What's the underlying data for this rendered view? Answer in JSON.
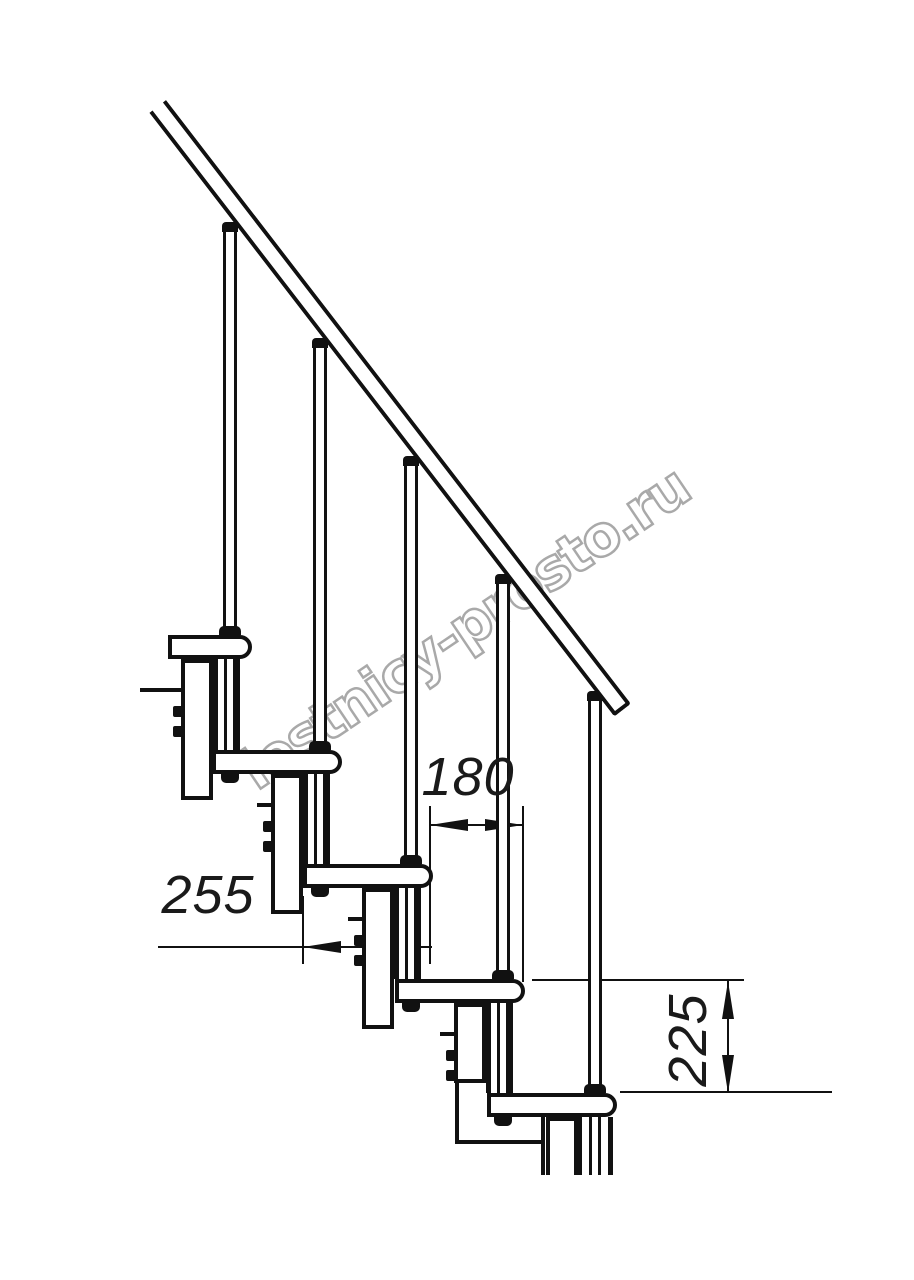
{
  "watermark": {
    "text": "lestnicy-prosto.ru",
    "stroke_color": "#a9a9a9"
  },
  "dimensions": {
    "step_run": {
      "label": "180"
    },
    "tread_depth": {
      "label": "255"
    },
    "step_rise": {
      "label": "225"
    }
  },
  "drawing": {
    "line_color": "#111111",
    "background": "#ffffff",
    "primitives": [
      [
        "tl",
        429,
        806,
        2,
        158,
        "extension-line"
      ],
      [
        "tl",
        522,
        806,
        2,
        176,
        "extension-line"
      ],
      [
        "tl",
        302,
        896,
        2,
        68,
        "extension-line"
      ],
      [
        "tl",
        158,
        946,
        274,
        2,
        "dimension-line-255"
      ],
      [
        "tl",
        430,
        824,
        94,
        2,
        "dimension-line-180"
      ],
      [
        "tl",
        532,
        979,
        212,
        2,
        "extension-line"
      ],
      [
        "tl",
        620,
        1091,
        212,
        2,
        "extension-line"
      ],
      [
        "tl",
        727,
        981,
        2,
        112,
        "dimension-line-225"
      ],
      [
        "al",
        303,
        941,
        0,
        0,
        "dimension-arrow"
      ],
      [
        "ar",
        389,
        941,
        0,
        0,
        "dimension-arrow"
      ],
      [
        "al",
        430,
        819,
        0,
        0,
        "dimension-arrow"
      ],
      [
        "ar",
        485,
        819,
        0,
        0,
        "dimension-arrow"
      ],
      [
        "au",
        722,
        981,
        0,
        0,
        "dimension-arrow"
      ],
      [
        "ad",
        722,
        1055,
        0,
        0,
        "dimension-arrow"
      ],
      [
        "col",
        181,
        659,
        32,
        141,
        "support-column"
      ],
      [
        "col",
        271,
        774,
        32,
        140,
        "support-column"
      ],
      [
        "col",
        362,
        888,
        32,
        141,
        "support-column"
      ],
      [
        "col",
        454,
        1003,
        32,
        80,
        "support-column"
      ],
      [
        "colo",
        546,
        1117,
        32,
        58,
        "support-column"
      ],
      [
        "bar",
        455,
        1083,
        4,
        60,
        "frame-detail"
      ],
      [
        "bar",
        455,
        1140,
        90,
        4,
        "frame-detail"
      ],
      [
        "bar",
        541,
        1117,
        4,
        58,
        "frame-detail"
      ],
      [
        "bar",
        140,
        688,
        45,
        4,
        "mount-tab"
      ],
      [
        "bar",
        257,
        803,
        16,
        4,
        "mount-tab"
      ],
      [
        "bar",
        348,
        917,
        16,
        4,
        "mount-tab"
      ],
      [
        "bar",
        440,
        1032,
        16,
        4,
        "mount-tab"
      ],
      [
        "tube",
        213,
        659,
        27,
        91,
        "connector-tube"
      ],
      [
        "rodp",
        224,
        659,
        12,
        91,
        "threaded-rod"
      ],
      [
        "tube",
        303,
        774,
        27,
        90,
        "connector-tube"
      ],
      [
        "rodp",
        314,
        774,
        12,
        90,
        "threaded-rod"
      ],
      [
        "tube",
        394,
        888,
        27,
        91,
        "connector-tube"
      ],
      [
        "rodp",
        405,
        888,
        12,
        91,
        "threaded-rod"
      ],
      [
        "tube",
        486,
        1003,
        27,
        90,
        "connector-tube"
      ],
      [
        "rodp",
        497,
        1003,
        12,
        90,
        "threaded-rod"
      ],
      [
        "tube",
        577,
        1117,
        36,
        58,
        "connector-tube"
      ],
      [
        "rodp",
        589,
        1117,
        12,
        58,
        "threaded-rod"
      ],
      [
        "bolt",
        173,
        706,
        11,
        11,
        "bolt"
      ],
      [
        "bolt",
        173,
        726,
        11,
        11,
        "bolt"
      ],
      [
        "bolt",
        263,
        821,
        11,
        11,
        "bolt"
      ],
      [
        "bolt",
        263,
        841,
        11,
        11,
        "bolt"
      ],
      [
        "bolt",
        354,
        935,
        11,
        11,
        "bolt"
      ],
      [
        "bolt",
        354,
        955,
        11,
        11,
        "bolt"
      ],
      [
        "bolt",
        446,
        1050,
        11,
        11,
        "bolt"
      ],
      [
        "bolt",
        446,
        1070,
        11,
        11,
        "bolt"
      ],
      [
        "tread",
        168,
        635,
        84,
        24,
        "stair-tread"
      ],
      [
        "tread",
        212,
        750,
        130,
        24,
        "stair-tread"
      ],
      [
        "tread",
        303,
        864,
        130,
        24,
        "stair-tread"
      ],
      [
        "tread",
        395,
        979,
        130,
        24,
        "stair-tread"
      ],
      [
        "tread",
        487,
        1093,
        130,
        24,
        "stair-tread"
      ],
      [
        "nut",
        221,
        774,
        18,
        9,
        "fixing-nut"
      ],
      [
        "nut",
        311,
        888,
        18,
        9,
        "fixing-nut"
      ],
      [
        "nut",
        402,
        1003,
        18,
        9,
        "fixing-nut"
      ],
      [
        "nut",
        494,
        1117,
        18,
        9,
        "fixing-nut"
      ],
      [
        "bal",
        223,
        230,
        14,
        405,
        "baluster"
      ],
      [
        "bal",
        313,
        346,
        14,
        404,
        "baluster"
      ],
      [
        "bal",
        404,
        464,
        14,
        400,
        "baluster"
      ],
      [
        "bal",
        496,
        582,
        14,
        397,
        "baluster"
      ],
      [
        "bal",
        588,
        699,
        14,
        394,
        "baluster"
      ],
      [
        "cap",
        222,
        222,
        16,
        10,
        "baluster-top-cap"
      ],
      [
        "cap",
        312,
        338,
        16,
        10,
        "baluster-top-cap"
      ],
      [
        "cap",
        403,
        456,
        16,
        10,
        "baluster-top-cap"
      ],
      [
        "cap",
        495,
        574,
        16,
        10,
        "baluster-top-cap"
      ],
      [
        "cap",
        587,
        691,
        16,
        10,
        "baluster-top-cap"
      ],
      [
        "base",
        219,
        626,
        22,
        9,
        "baluster-base"
      ],
      [
        "base",
        309,
        741,
        22,
        9,
        "baluster-base"
      ],
      [
        "base",
        400,
        855,
        22,
        9,
        "baluster-base"
      ],
      [
        "base",
        492,
        970,
        22,
        9,
        "baluster-base"
      ],
      [
        "base",
        584,
        1084,
        22,
        9,
        "baluster-base"
      ]
    ]
  }
}
